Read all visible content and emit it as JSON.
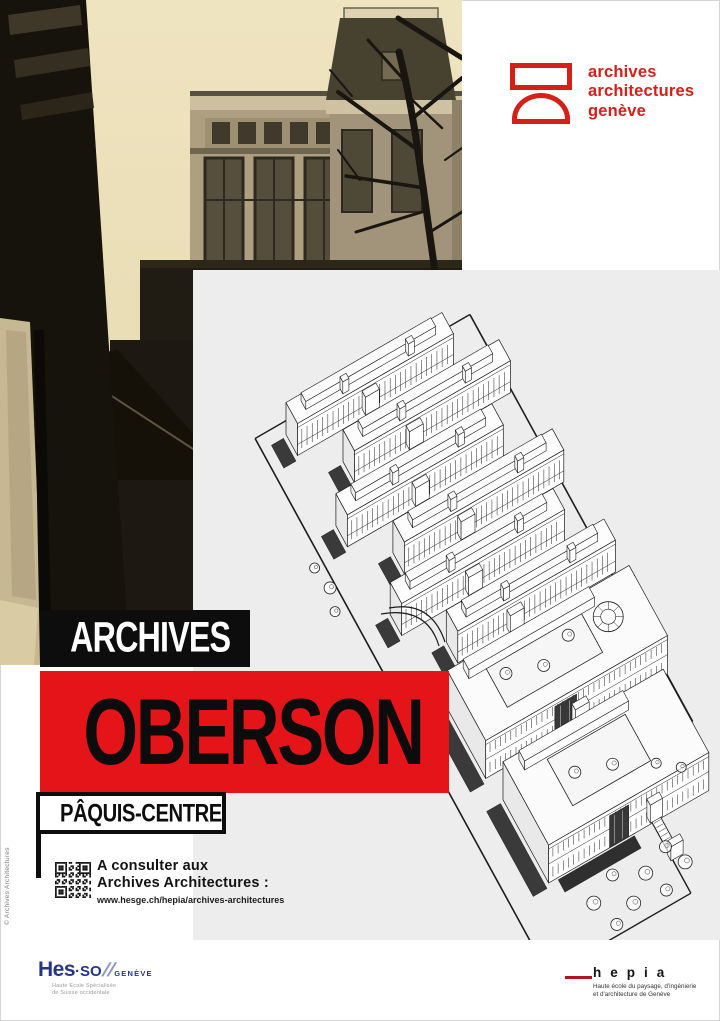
{
  "poster_title": "Archives Oberson Pâquis-Centre",
  "brand": {
    "line1": "archives",
    "line2": "architectures",
    "line3": "genève"
  },
  "title": {
    "kicker": "ARCHIVES",
    "name": "OBERSON",
    "location": "PÂQUIS-CENTRE"
  },
  "consult": {
    "line1": "A consulter aux",
    "line2": "Archives Architectures :",
    "url": "www.hesge.ch/hepia/archives-architectures"
  },
  "copyright": "© Archives Architectures",
  "footer": {
    "hesso": {
      "main": "Hes",
      "so": "·SO",
      "slashes": "//",
      "region": "GENÈVE",
      "sub1": "Haute Ecole Spécialisée",
      "sub2": "de Suisse occidentale"
    },
    "hepia": {
      "name": "hepia",
      "sub1": "Haute école du paysage, d'ingénierie",
      "sub2": "et d'architecture de Genève"
    }
  },
  "colors": {
    "red": "#e41419",
    "logo_red": "#d42019",
    "panel_gray": "#ededee",
    "hesso_blue": "#27348b",
    "hepia_line": "#b5121f"
  }
}
